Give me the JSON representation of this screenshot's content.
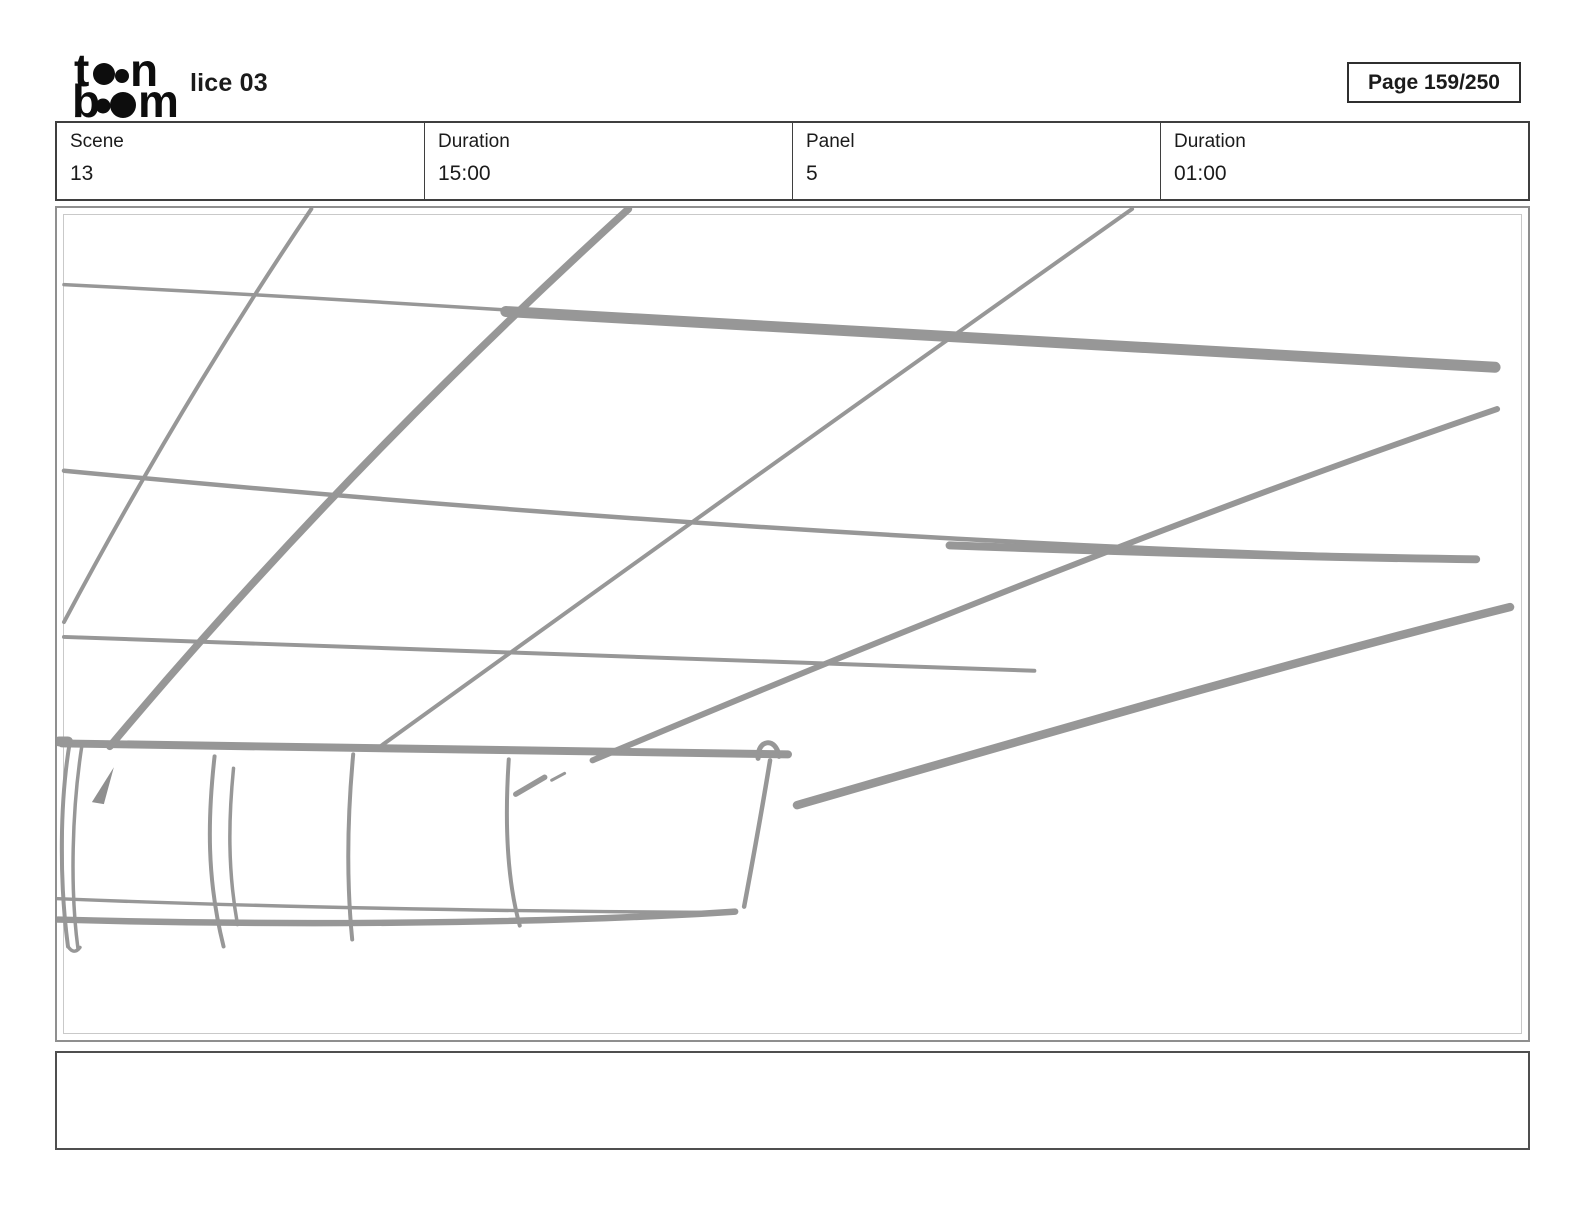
{
  "header": {
    "title": "lice 03",
    "page_badge": "Page 159/250",
    "logo": {
      "name": "toonboom-logo",
      "color": "#0d0d0d",
      "elements": [
        {
          "t": "text",
          "ch": "t",
          "x": 2,
          "y": 40,
          "s": 46
        },
        {
          "t": "dot",
          "x": 32,
          "y": 28,
          "r": 11
        },
        {
          "t": "dot",
          "x": 50,
          "y": 30,
          "r": 7
        },
        {
          "t": "text",
          "ch": "n",
          "x": 58,
          "y": 40,
          "s": 46
        },
        {
          "t": "text",
          "ch": "b",
          "x": 0,
          "y": 71,
          "s": 46
        },
        {
          "t": "dot",
          "x": 31,
          "y": 60,
          "r": 7.5
        },
        {
          "t": "dot",
          "x": 51,
          "y": 59,
          "r": 13
        },
        {
          "t": "text",
          "ch": "m",
          "x": 66,
          "y": 71,
          "s": 46
        }
      ]
    }
  },
  "info_table": {
    "cells": [
      {
        "label": "Scene",
        "value": "13"
      },
      {
        "label": "Duration",
        "value": "15:00"
      },
      {
        "label": "Panel",
        "value": "5"
      },
      {
        "label": "Duration",
        "value": "01:00"
      }
    ]
  },
  "panel": {
    "border_outer": "#8f8f8f",
    "border_inner": "#c9c9c9"
  },
  "sketch": {
    "color": "#979797",
    "fill_color": "#8f8f8f",
    "strokes": [
      {
        "d": "M310,207 Q180,400 62,622",
        "w": 4
      },
      {
        "d": "M628,207 Q340,470 108,747",
        "w": 7.5
      },
      {
        "d": "M1133,207 Q790,450 375,750",
        "w": 4
      },
      {
        "d": "M62,283 Q300,295 560,312",
        "w": 3.5
      },
      {
        "d": "M505,310 Q1000,338 1497,366",
        "w": 11
      },
      {
        "d": "M62,470 C500,512 1000,548 1478,559",
        "w": 4.5
      },
      {
        "d": "M950,545 Q1250,556 1478,559",
        "w": 8
      },
      {
        "d": "M62,637 Q550,652 1035,671",
        "w": 4
      },
      {
        "d": "M60,744 Q400,750 788,755",
        "w": 8
      },
      {
        "d": "M57,742 L66,742",
        "w": 10
      },
      {
        "d": "M592,761 C700,716 1100,545 1499,408",
        "w": 6
      },
      {
        "d": "M797,806 C1050,733 1300,660 1512,607",
        "w": 8.5
      },
      {
        "d": "M68,742 C58,800 57,880 66,948",
        "w": 4
      },
      {
        "d": "M80,746 C70,810 68,890 76,950",
        "w": 3.5
      },
      {
        "d": "M66,948 Q72,957 78,949",
        "w": 3.5
      },
      {
        "d": "M213,757 C206,820 205,880 222,948",
        "w": 4
      },
      {
        "d": "M232,769 C227,820 226,870 236,926",
        "w": 3.5
      },
      {
        "d": "M352,755 C346,820 345,880 351,941",
        "w": 4
      },
      {
        "d": "M508,760 C504,820 506,880 519,927",
        "w": 4
      },
      {
        "d": "M770,761 C762,810 752,865 744,908",
        "w": 4.5
      },
      {
        "d": "M758,759 C757,740 776,737 779,757",
        "w": 5
      },
      {
        "d": "M515,795 L544,778",
        "w": 5.5
      },
      {
        "d": "M551,781 L564,774",
        "w": 3
      },
      {
        "d": "M56,900 C300,910 550,913 734,914",
        "w": 3.5
      },
      {
        "d": "M56,921 C350,929 600,922 735,913",
        "w": 6.5
      }
    ],
    "fills": [
      {
        "d": "M90,803 L112,768 L102,805 Z"
      }
    ]
  },
  "caption": {
    "text": ""
  }
}
